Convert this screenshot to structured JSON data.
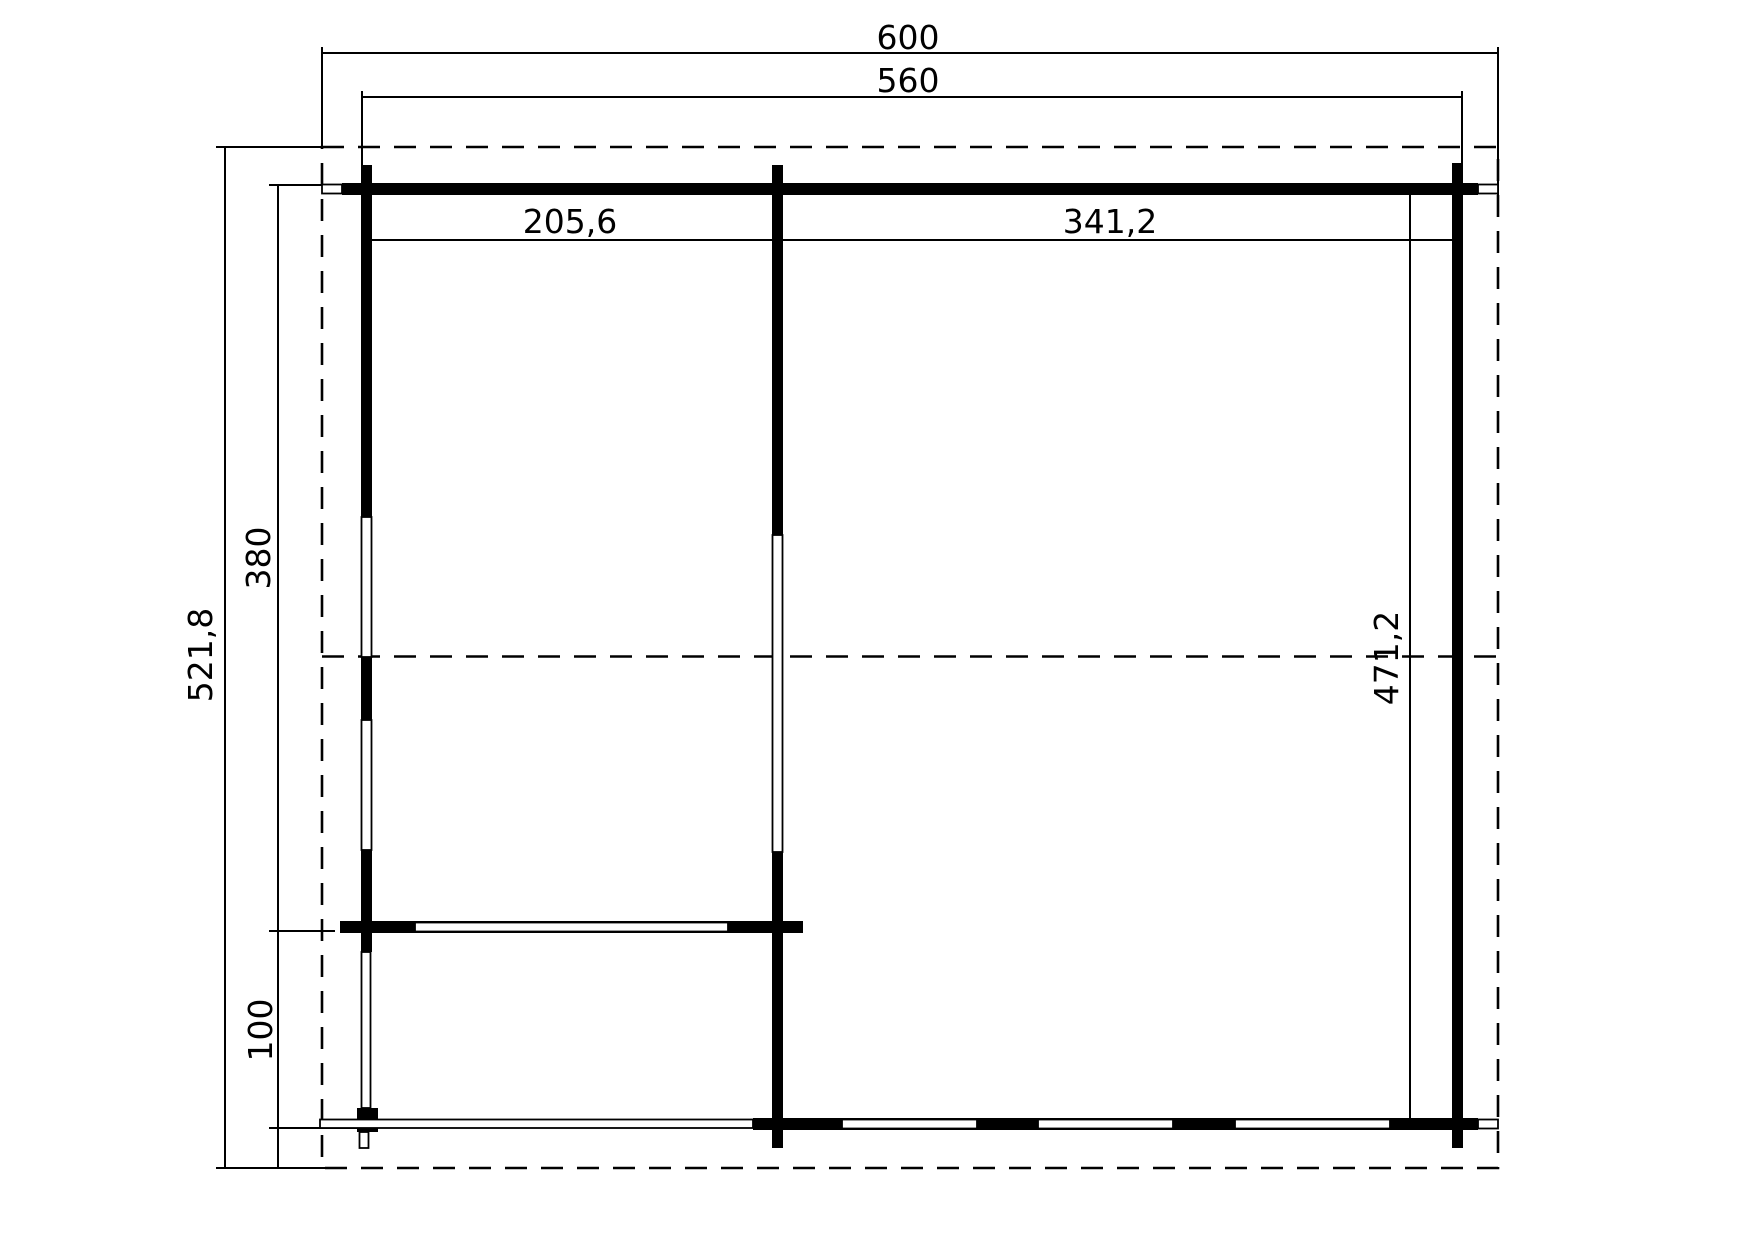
{
  "plan": {
    "type": "floor-plan",
    "colors": {
      "ink": "#000000",
      "paper": "#ffffff"
    },
    "dimension_labels": {
      "overall_width": "600",
      "building_width": "560",
      "left_room_width": "205,6",
      "right_room_width": "341,2",
      "overall_depth": "521,8",
      "main_room_depth": "380",
      "porch_depth": "100",
      "right_room_depth": "471,2"
    }
  }
}
